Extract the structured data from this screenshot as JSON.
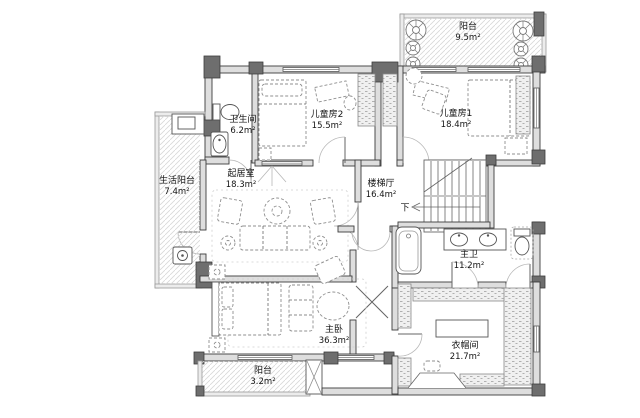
{
  "plan": {
    "type": "floor-plan",
    "language": "zh-CN",
    "rooms": [
      {
        "id": "balcony-top",
        "name": "阳台",
        "area": "9.5m²"
      },
      {
        "id": "children-room-2",
        "name": "儿童房2",
        "area": "15.5m²"
      },
      {
        "id": "children-room-1",
        "name": "儿童房1",
        "area": "18.4m²"
      },
      {
        "id": "bathroom",
        "name": "卫生间",
        "area": "6.2m²"
      },
      {
        "id": "living-room",
        "name": "起居室",
        "area": "18.3m²"
      },
      {
        "id": "utility-balcony",
        "name": "生活阳台",
        "area": "7.4m²"
      },
      {
        "id": "stair-hall",
        "name": "楼梯厅",
        "area": "16.4m²"
      },
      {
        "id": "master-bathroom",
        "name": "主卫",
        "area": "11.2m²"
      },
      {
        "id": "master-bedroom",
        "name": "主卧",
        "area": "36.3m²"
      },
      {
        "id": "balcony-bottom",
        "name": "阳台",
        "area": "3.2m²"
      },
      {
        "id": "walk-in-closet",
        "name": "衣帽间",
        "area": "21.7m²"
      }
    ],
    "stairs": {
      "direction_label": "下"
    },
    "colors": {
      "background": "#ffffff",
      "wall_fill": "#dedede",
      "wall_stroke": "#3c3c3c",
      "column_fill": "#6e6e6e",
      "furniture_stroke": "#8f8f8f",
      "hatch": "#d8d8d8",
      "text": "#141414"
    }
  }
}
